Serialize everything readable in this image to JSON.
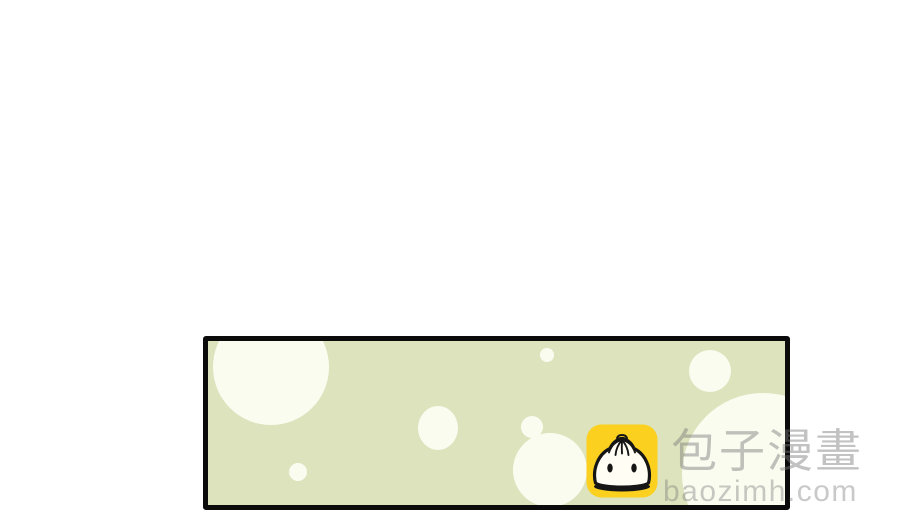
{
  "page": {
    "background": "#ffffff"
  },
  "panel": {
    "background": "#dce3bd",
    "border_color": "#0b0b0b",
    "dot_color": "#fbfcf0",
    "dots": [
      {
        "left": 5,
        "top": -32,
        "width": 116,
        "height": 116
      },
      {
        "left": 81,
        "top": 122,
        "width": 18,
        "height": 18
      },
      {
        "left": 210,
        "top": 65,
        "width": 40,
        "height": 44
      },
      {
        "left": 332,
        "top": 7,
        "width": 14,
        "height": 14
      },
      {
        "left": 313,
        "top": 75,
        "width": 22,
        "height": 22
      },
      {
        "left": 305,
        "top": 92,
        "width": 74,
        "height": 74
      },
      {
        "left": 481,
        "top": 9,
        "width": 42,
        "height": 42
      },
      {
        "left": 474,
        "top": 52,
        "width": 162,
        "height": 162
      }
    ]
  },
  "watermark": {
    "site_name": "包子漫畫",
    "site_url": "baozimh.com",
    "text_color": "rgba(120,120,120,0.45)",
    "url_color": "rgba(120,120,120,0.40)",
    "icon": {
      "name": "baozi-app-icon",
      "background": "#fbd01e",
      "outline": "#161616",
      "bun_fill": "#fffdf4"
    }
  }
}
